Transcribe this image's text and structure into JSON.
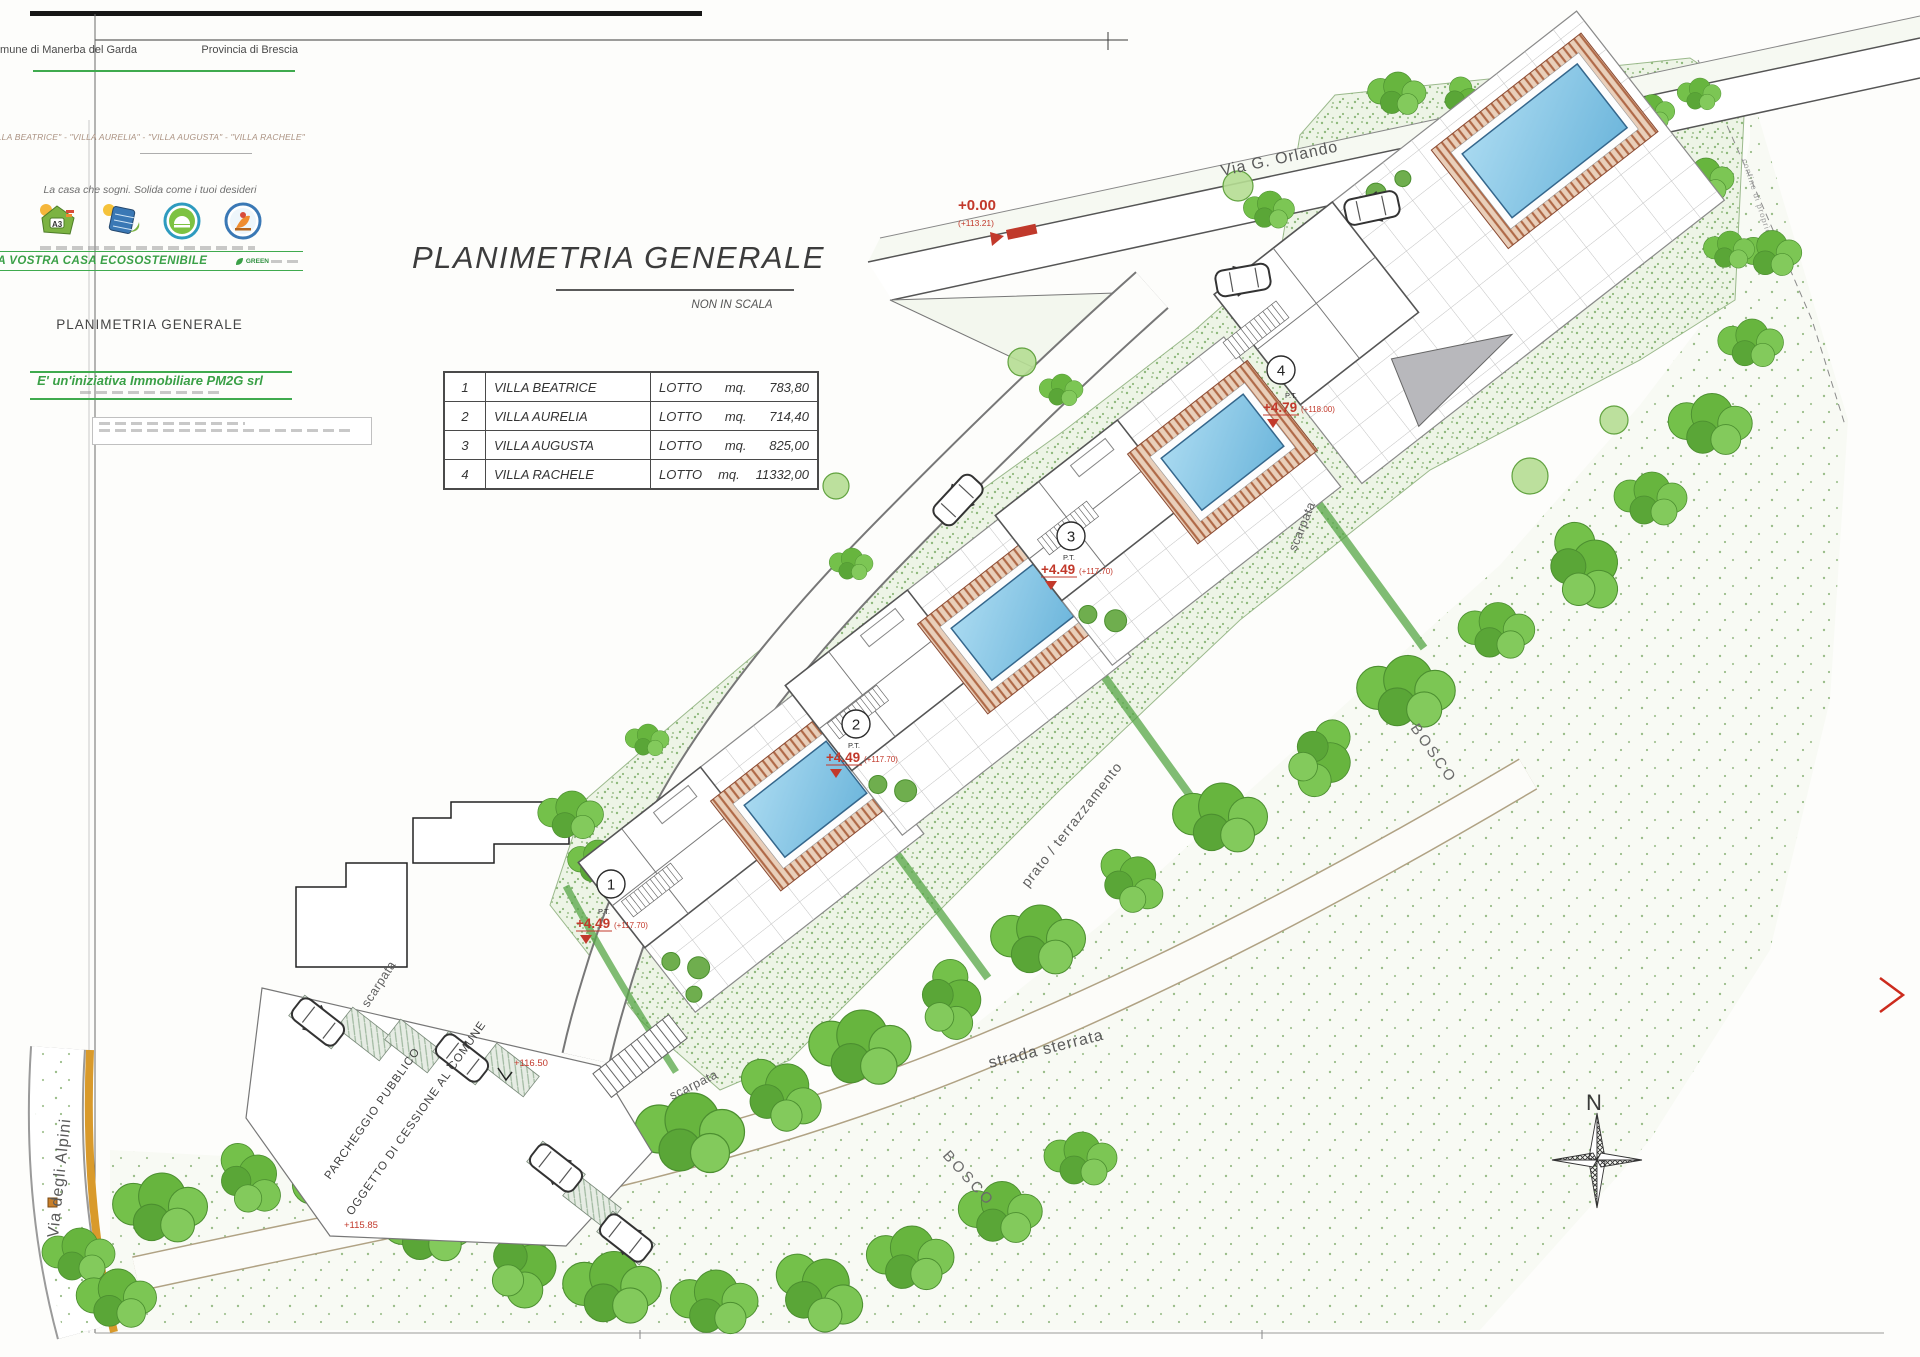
{
  "header": {
    "comune": "Comune di Manerba del Garda",
    "provincia": "Provincia di Brescia"
  },
  "titleblock": {
    "villas_line": "\"VILLA BEATRICE\" - \"VILLA AURELIA\" - \"VILLA AUGUSTA\" - \"VILLA RACHELE\"",
    "slogan": "La casa che sogni. Solida come i tuoi desideri",
    "eco_banner": "LA VOSTRA CASA ECOSOSTENIBILE",
    "eco_logo": "GREEN",
    "drawing_name": "PLANIMETRIA GENERALE",
    "initiative": "E' un'iniziativa Immobiliare PM2G srl"
  },
  "title": {
    "main": "PLANIMETRIA GENERALE",
    "scale_note": "NON IN SCALA"
  },
  "lots_table": {
    "rows": [
      {
        "num": "1",
        "name": "VILLA BEATRICE",
        "label": "LOTTO",
        "unit": "mq.",
        "area": "783,80"
      },
      {
        "num": "2",
        "name": "VILLA AURELIA",
        "label": "LOTTO",
        "unit": "mq.",
        "area": "714,40"
      },
      {
        "num": "3",
        "name": "VILLA AUGUSTA",
        "label": "LOTTO",
        "unit": "mq.",
        "area": "825,00"
      },
      {
        "num": "4",
        "name": "VILLA RACHELE",
        "label": "LOTTO",
        "unit": "mq.",
        "area": "11332,00"
      }
    ]
  },
  "map": {
    "roads": {
      "via_orlando": "Via G. Orlando",
      "via_alpini": "Via degli Alpini",
      "strada_sterrata": "strada sterrata"
    },
    "labels": {
      "bosco": "BOSCO",
      "prato": "prato / terrazzamento",
      "scarpata": "scarpata",
      "parcheggio1": "PARCHEGGIO PUBBLICO",
      "parcheggio2": "OGGETTO DI CESSIONE AL COMUNE",
      "confine": "confine di proprietà"
    },
    "benchmark": {
      "rel": "+0.00",
      "abs": "(+113.21)"
    },
    "spot_heights": {
      "h1": "+116.50",
      "h2": "+115.85"
    },
    "markers": [
      {
        "num": "1",
        "pt": "P.T.",
        "rel": "+4.49",
        "abs": "(+117.70)"
      },
      {
        "num": "2",
        "pt": "P.T.",
        "rel": "+4.49",
        "abs": "(+117.70)"
      },
      {
        "num": "3",
        "pt": "P.T.",
        "rel": "+4.49",
        "abs": "(+117.70)"
      },
      {
        "num": "4",
        "pt": "P.T.",
        "rel": "+4.79",
        "abs": "(+118.00)"
      }
    ],
    "compass": {
      "north": "N"
    }
  }
}
